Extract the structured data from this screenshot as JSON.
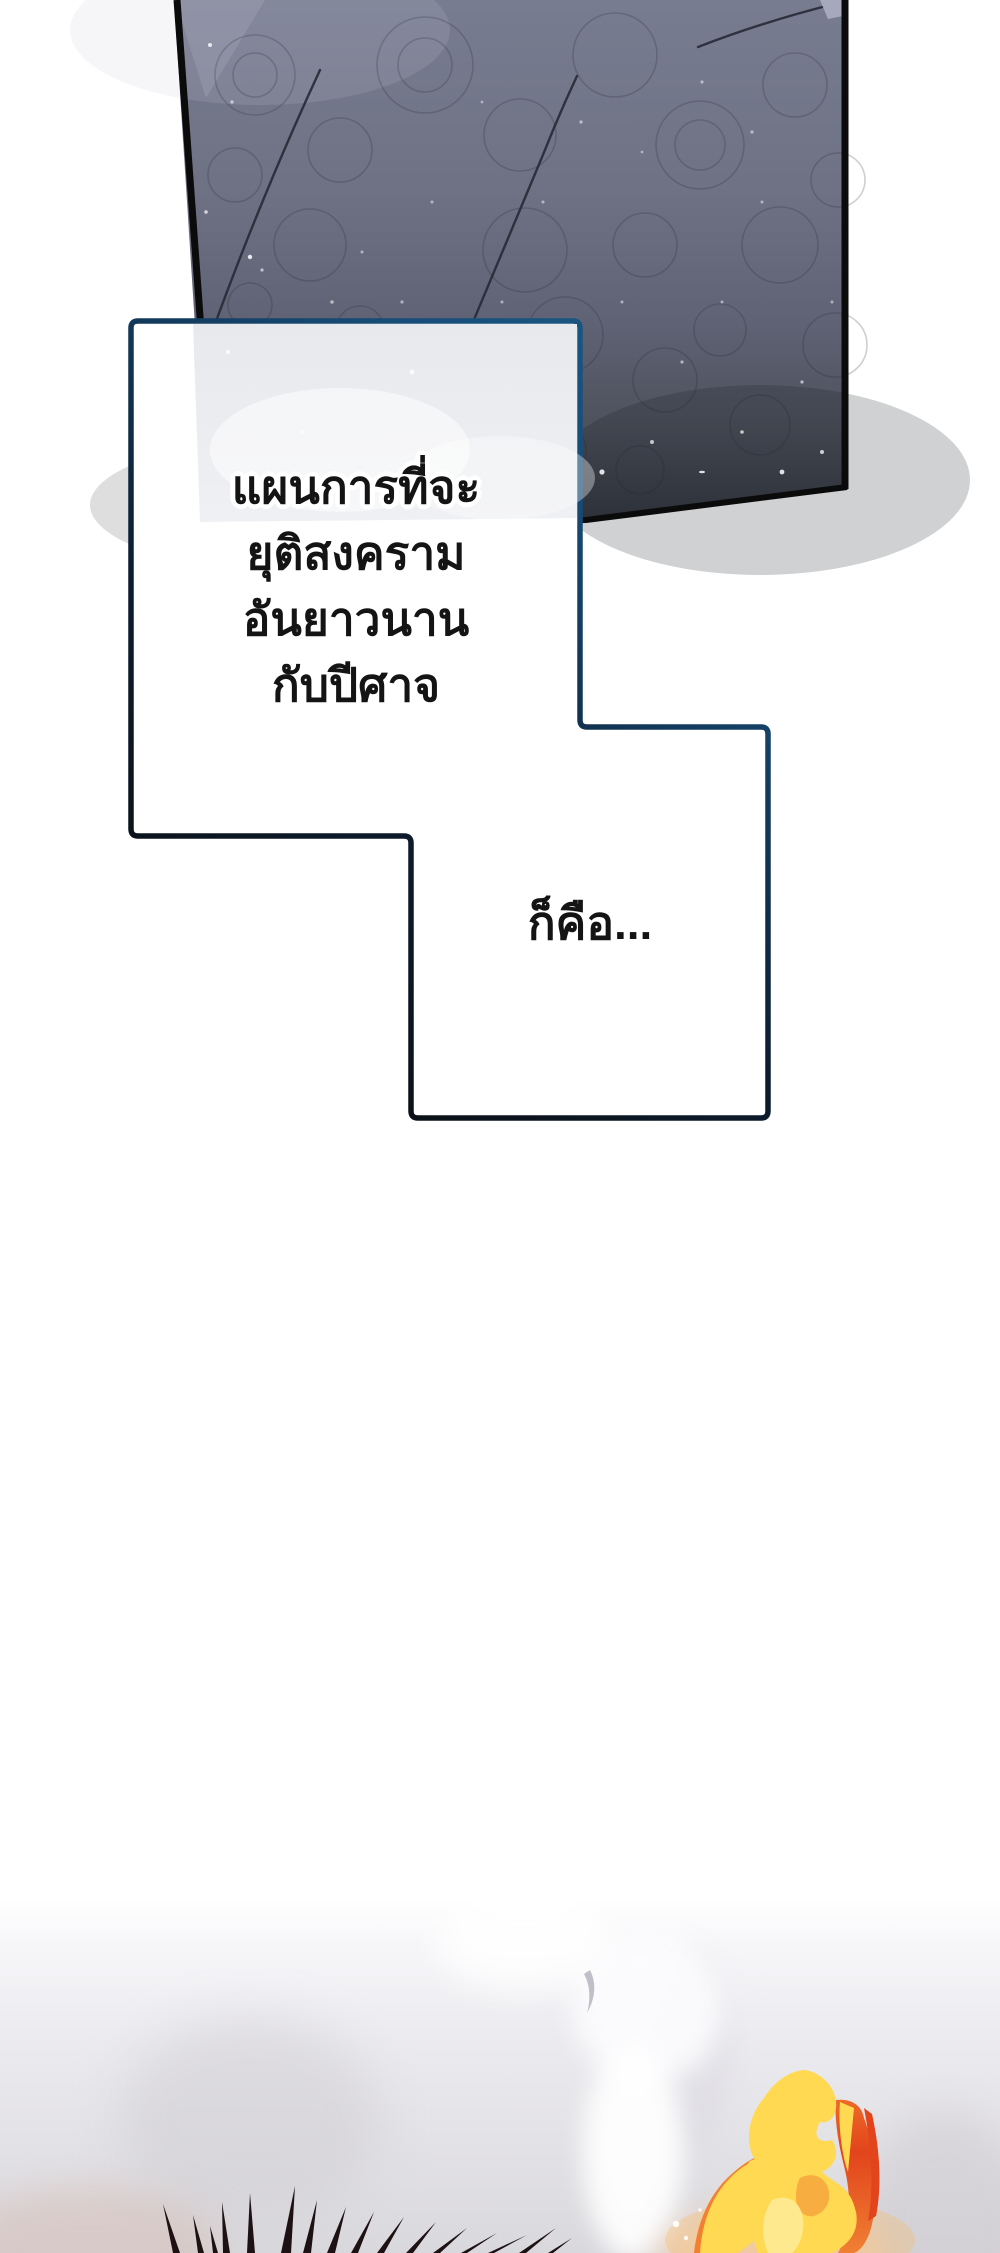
{
  "page": {
    "kind": "webtoon comic page segment",
    "width": 1000,
    "height": 2253,
    "background": "#ffffff"
  },
  "top_panel": {
    "description": "dark ornate engraved panel with curved whisker lines and white speckles",
    "border_color": "#0b0b0b",
    "gradient_top": "#787c90",
    "gradient_mid": "#5f6375",
    "gradient_bottom": "#363943",
    "corner_highlight": "#a6a9bc",
    "speckle_color": "#ffffff"
  },
  "speech_bubbles": {
    "fill": "#ffffff",
    "border_top_color": "#1e6090",
    "border_mid_color": "#164a74",
    "border_bottom_color": "#0a0a0a",
    "ghost_panel_tint": "#e8e9ed",
    "text_color": "#141414",
    "bubble1_lines": [
      "แผนการที่จะ",
      "ยุติสงคราม",
      "อันยาวนาน",
      "กับปีศาจ"
    ],
    "bubble2_text": "ก็คือ..."
  },
  "bottom_art": {
    "mist_light": "#f3f2f6",
    "mist_dark": "#d8d7db",
    "warm_tint": "#d6bcb4",
    "spike_color": "#1d1113",
    "spike_count": 16,
    "flame_yellow": "#ffd952",
    "flame_core": "#ffe98e",
    "flame_orange": "#f28030",
    "flame_inner_orange": "#f6a43c",
    "flame_red": "#e2441c",
    "glow_orange": "#ffb347",
    "sparkle": "#ffffff",
    "wisp_gray": "#8c8e9b"
  }
}
